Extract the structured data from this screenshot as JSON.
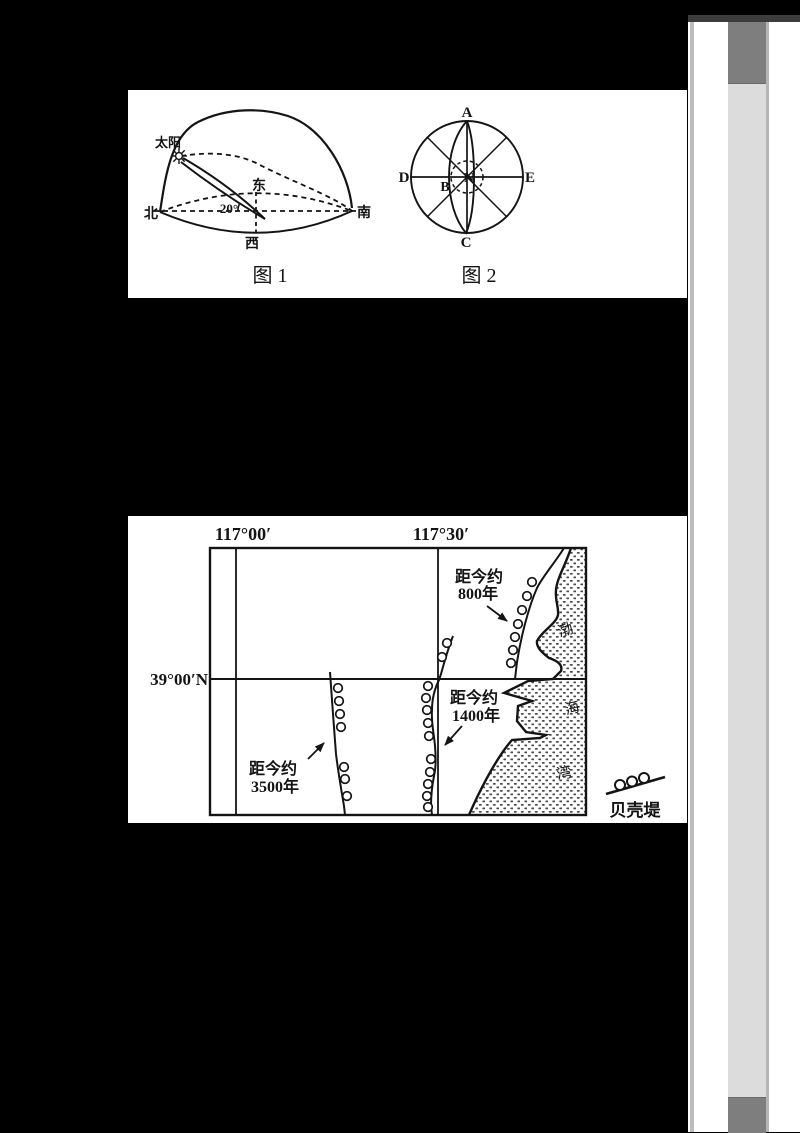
{
  "figure1": {
    "sun_label": "太阳",
    "east": "东",
    "west": "西",
    "north": "北",
    "south": "南",
    "angle": "20°",
    "caption": "图 1"
  },
  "figure2": {
    "a": "A",
    "b": "B",
    "c": "C",
    "d": "D",
    "e": "E",
    "n": "N",
    "caption": "图 2"
  },
  "map": {
    "lon_left": "117°00′",
    "lon_right": "117°30′",
    "lat": "39°00′N",
    "ridge_800": {
      "line1": "距今约",
      "line2": "800年"
    },
    "ridge_1400": {
      "line1": "距今约",
      "line2": "1400年"
    },
    "ridge_3500": {
      "line1": "距今约",
      "line2": "3500年"
    },
    "sea": {
      "bo": "渤",
      "hai": "海",
      "wan": "湾"
    },
    "legend_label": "贝壳堤"
  },
  "colors": {
    "page_background": "#000000",
    "paper": "#ffffff",
    "ink": "#141414",
    "scroll_track": "#dcdcdc",
    "scroll_thumb": "#7e7e7e",
    "edge_line": "#bdbdbd",
    "top_band": "#3c3c3c"
  }
}
